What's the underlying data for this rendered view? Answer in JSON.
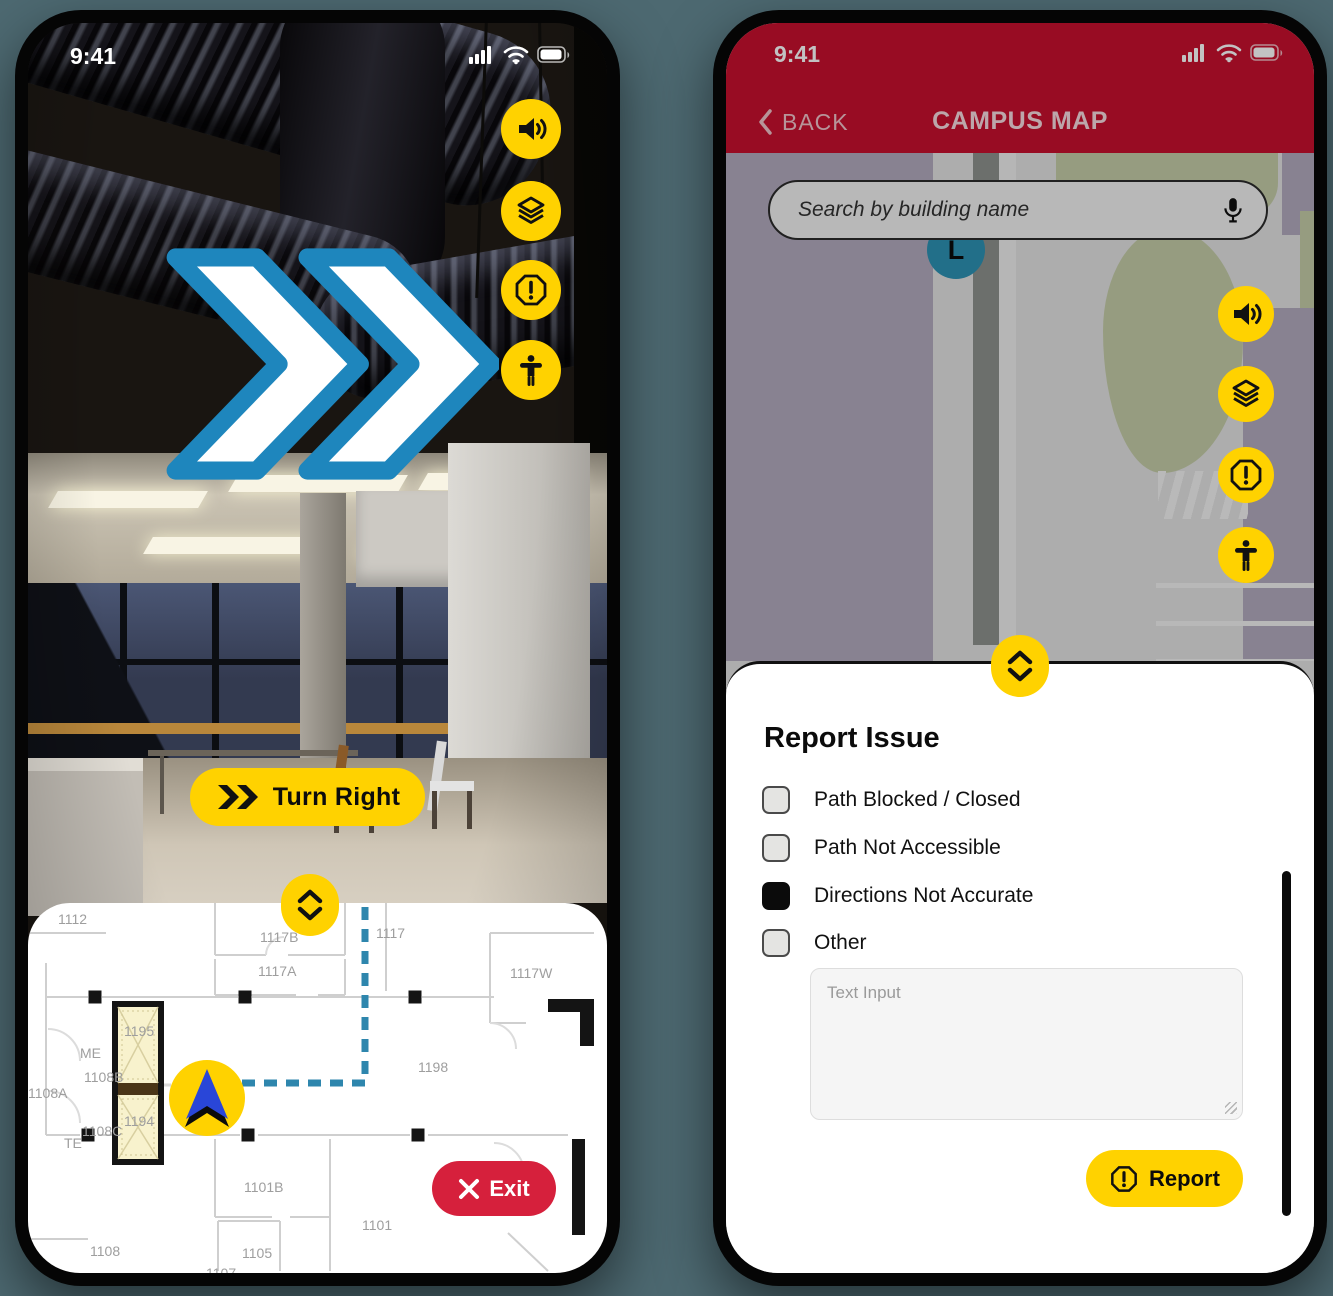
{
  "colors": {
    "accent_yellow": "#FFD200",
    "brand_red": "#C8102E",
    "exit_red": "#D6203C",
    "route_blue": "#2E86AD",
    "chevron_blue": "#1E86BD",
    "marker_teal": "#2D93B5"
  },
  "left_phone": {
    "status_bar": {
      "time": "9:41"
    },
    "side_buttons": [
      {
        "icon": "audio"
      },
      {
        "icon": "layers"
      },
      {
        "icon": "report-issue"
      },
      {
        "icon": "accessibility"
      }
    ],
    "instruction_button": {
      "label": "Turn Right"
    },
    "exit_button": {
      "label": "Exit"
    },
    "floorplan": {
      "rooms": [
        {
          "label": "1112",
          "x": 30,
          "y": 8
        },
        {
          "label": "1117B",
          "x": 232,
          "y": 26
        },
        {
          "label": "1117",
          "x": 348,
          "y": 22
        },
        {
          "label": "1117A",
          "x": 230,
          "y": 60
        },
        {
          "label": "1117W",
          "x": 482,
          "y": 62
        },
        {
          "label": "1195",
          "x": 96,
          "y": 120
        },
        {
          "label": "ME",
          "x": 52,
          "y": 142
        },
        {
          "label": "1108B",
          "x": 56,
          "y": 166
        },
        {
          "label": "1108A",
          "x": 0,
          "y": 182
        },
        {
          "label": "1194",
          "x": 96,
          "y": 210
        },
        {
          "label": "1108C",
          "x": 54,
          "y": 220
        },
        {
          "label": "TE",
          "x": 36,
          "y": 232
        },
        {
          "label": "1198",
          "x": 390,
          "y": 156
        },
        {
          "label": "1101B",
          "x": 216,
          "y": 276
        },
        {
          "label": "1101",
          "x": 334,
          "y": 314
        },
        {
          "label": "1105",
          "x": 214,
          "y": 342
        },
        {
          "label": "1108",
          "x": 62,
          "y": 340
        },
        {
          "label": "1107",
          "x": 178,
          "y": 362
        }
      ]
    }
  },
  "right_phone": {
    "status_bar": {
      "time": "9:41"
    },
    "nav": {
      "back_label": "BACK",
      "title": "CAMPUS MAP"
    },
    "search": {
      "placeholder": "Search by building name",
      "mic_icon": "microphone"
    },
    "map": {
      "marker_label": "L"
    },
    "side_buttons": [
      {
        "icon": "audio"
      },
      {
        "icon": "layers"
      },
      {
        "icon": "report-issue"
      },
      {
        "icon": "accessibility"
      }
    ],
    "report_sheet": {
      "title": "Report Issue",
      "options": [
        {
          "label": "Path Blocked / Closed",
          "checked": false
        },
        {
          "label": "Path Not Accessible",
          "checked": false
        },
        {
          "label": "Directions Not Accurate",
          "checked": true
        },
        {
          "label": "Other",
          "checked": false
        }
      ],
      "text_input": {
        "placeholder": "Text Input",
        "value": ""
      },
      "submit_label": "Report"
    }
  }
}
